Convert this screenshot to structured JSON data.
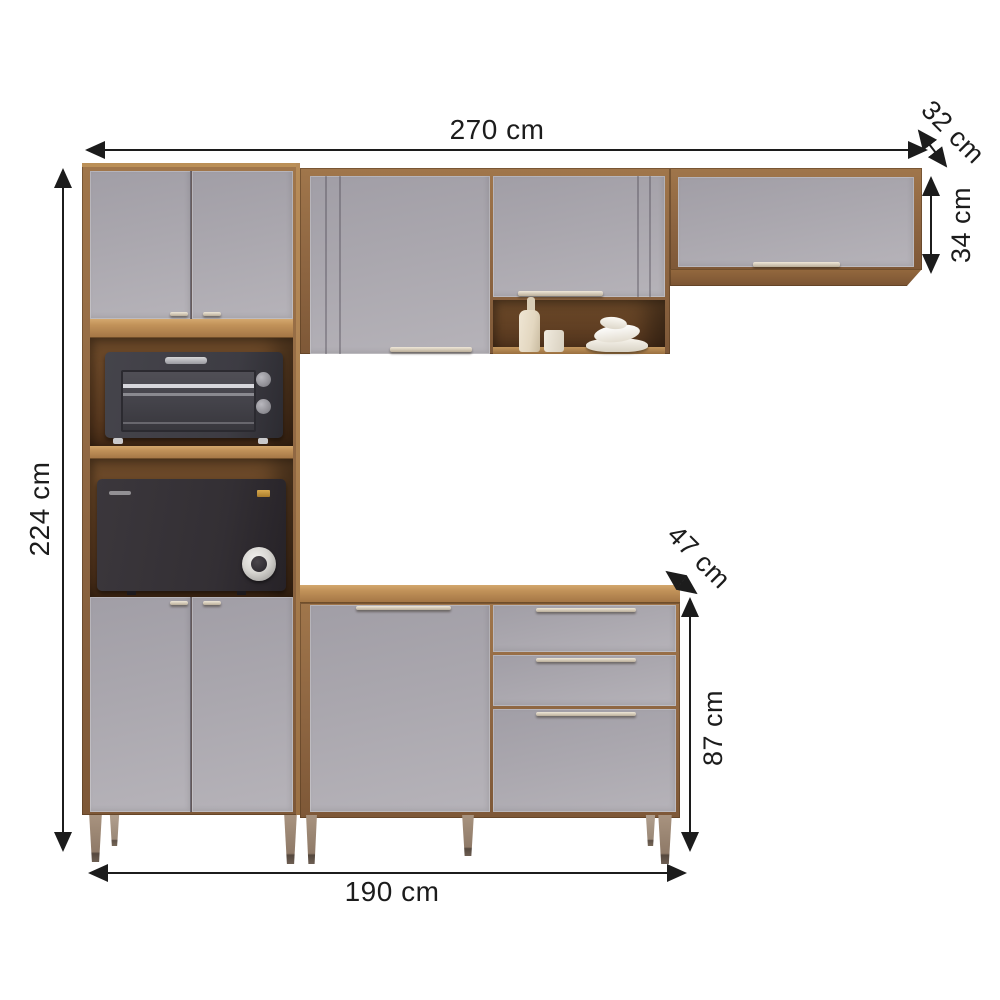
{
  "diagram": {
    "kind": "furniture-dimension-diagram",
    "subject": "modular kitchen cabinet set with oven and microwave niches",
    "unit": "cm"
  },
  "dims": {
    "total_width": "270 cm",
    "upper_depth": "32 cm",
    "upper_cabinet_height": "34 cm",
    "total_height": "224 cm",
    "counter_depth": "47 cm",
    "base_cabinet_height": "87 cm",
    "base_width": "190 cm"
  },
  "colors": {
    "background": "#ffffff",
    "dimension_line": "#1c1c1c",
    "wood_frame": "#8d6541",
    "wood_top_edge": "#c2935a",
    "niche_interior": "#5a3a20",
    "door_gray": "#aaa7ae",
    "handle_metal": "#d9cfc0",
    "leg_taupe": "#8f7a68",
    "appliance_dark": "#3a3840",
    "decor_cream": "#e9dfcc"
  },
  "parts": {
    "tall_cabinet": "tall pantry cabinet with upper doors, oven niche, microwave niche, lower doors",
    "wall_unit": "wall cabinet with two doors and open display shelf",
    "top_right_cabinet": "horizontal wall cabinet with flip door",
    "base_cabinet": "base counter cabinet with one door and three drawers"
  }
}
